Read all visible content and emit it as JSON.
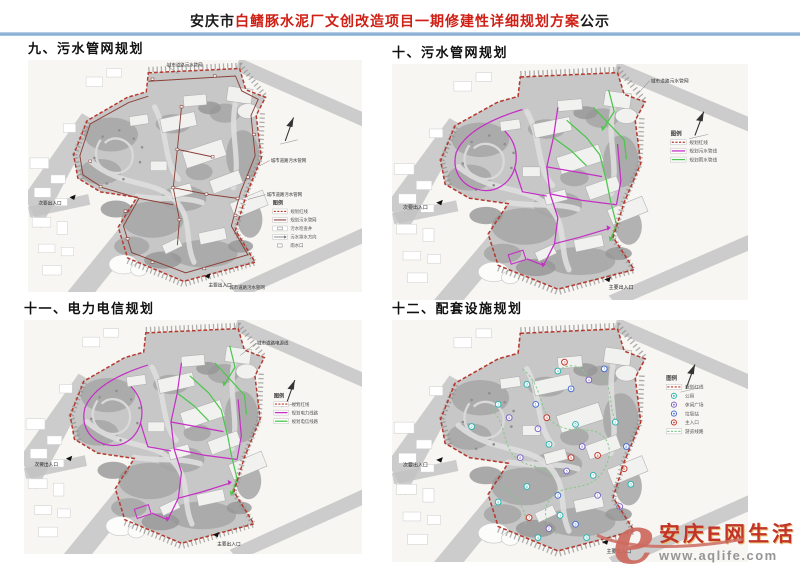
{
  "header": {
    "title_prefix": "安庆市",
    "title_red": "白鳍豚水泥厂文创改造项目一期修建性详细规划方案",
    "title_suffix": "公示"
  },
  "panels": [
    {
      "heading": "九、污水管网规划",
      "overlay": "sewage",
      "legend": {
        "title": "图例",
        "items": [
          {
            "swatch": "red-dashed",
            "label": "规划红线"
          },
          {
            "swatch": "sewage-line",
            "label": "规划污水管网"
          },
          {
            "swatch": "well-box",
            "label": "污水检查井"
          },
          {
            "swatch": "flow-arrow",
            "label": "污水排水方向"
          },
          {
            "swatch": "small-box",
            "label": "雨水口"
          }
        ]
      },
      "edge_labels": [
        "城市道路污水管网",
        "城市道路污水管网",
        "城市道路污水管网",
        "城市道路污水管网"
      ],
      "entrance_labels": [
        "次要出入口",
        "主要出入口"
      ]
    },
    {
      "heading": "十、污水管网规划",
      "overlay": "network",
      "legend": {
        "title": "图例",
        "items": [
          {
            "swatch": "red-dashed",
            "label": "规划红线"
          },
          {
            "swatch": "magenta-line",
            "label": "规划污水管线"
          },
          {
            "swatch": "green-line",
            "label": "规划雨水管线"
          }
        ]
      },
      "edge_labels": [
        "城市道路污水管网"
      ],
      "entrance_labels": [
        "次要出入口",
        "主要出入口"
      ]
    },
    {
      "heading": "十一、电力电信规划",
      "overlay": "network",
      "legend": {
        "title": "图例",
        "items": [
          {
            "swatch": "red-dashed",
            "label": "规划红线"
          },
          {
            "swatch": "magenta-line",
            "label": "规划电力线路"
          },
          {
            "swatch": "green-line",
            "label": "规划电信线路"
          }
        ]
      },
      "edge_labels": [
        "城市道路电源线"
      ],
      "entrance_labels": [
        "次要出入口",
        "主要出入口"
      ]
    },
    {
      "heading": "十二、配套设施规划",
      "overlay": "facilities",
      "legend": {
        "title": "图例",
        "items": [
          {
            "swatch": "red-dashed",
            "label": "规划红线"
          },
          {
            "swatch": "circle-cyan",
            "label": "公厕"
          },
          {
            "swatch": "circle-purple",
            "label": "休闲广场"
          },
          {
            "swatch": "circle-blue",
            "label": "垃圾站"
          },
          {
            "swatch": "circle-red",
            "label": "主入口"
          },
          {
            "swatch": "route-line",
            "label": "游览线路"
          }
        ]
      },
      "edge_labels": [],
      "entrance_labels": [
        "次要出入口",
        "主要出入口"
      ]
    }
  ],
  "watermark": {
    "logo_letter": "e",
    "site_name": "安庆E网生活",
    "url": "www.aqlife.com"
  },
  "colors": {
    "title_red": "#cf1f14",
    "rule_blue": "#8fb3d7",
    "boundary_red": "#b5392e",
    "sewage_line": "#8a4038",
    "magenta": "#c430c4",
    "green": "#4cc64c",
    "route_green": "#86c98b",
    "cyan": "#2fb3ae",
    "purple": "#7d66c4",
    "blue": "#4a6fd0",
    "marker_red": "#c03a2b",
    "watermark_red": "#c2342a",
    "watermark_logo": "#cd6a5f",
    "url_gray": "#969696"
  }
}
